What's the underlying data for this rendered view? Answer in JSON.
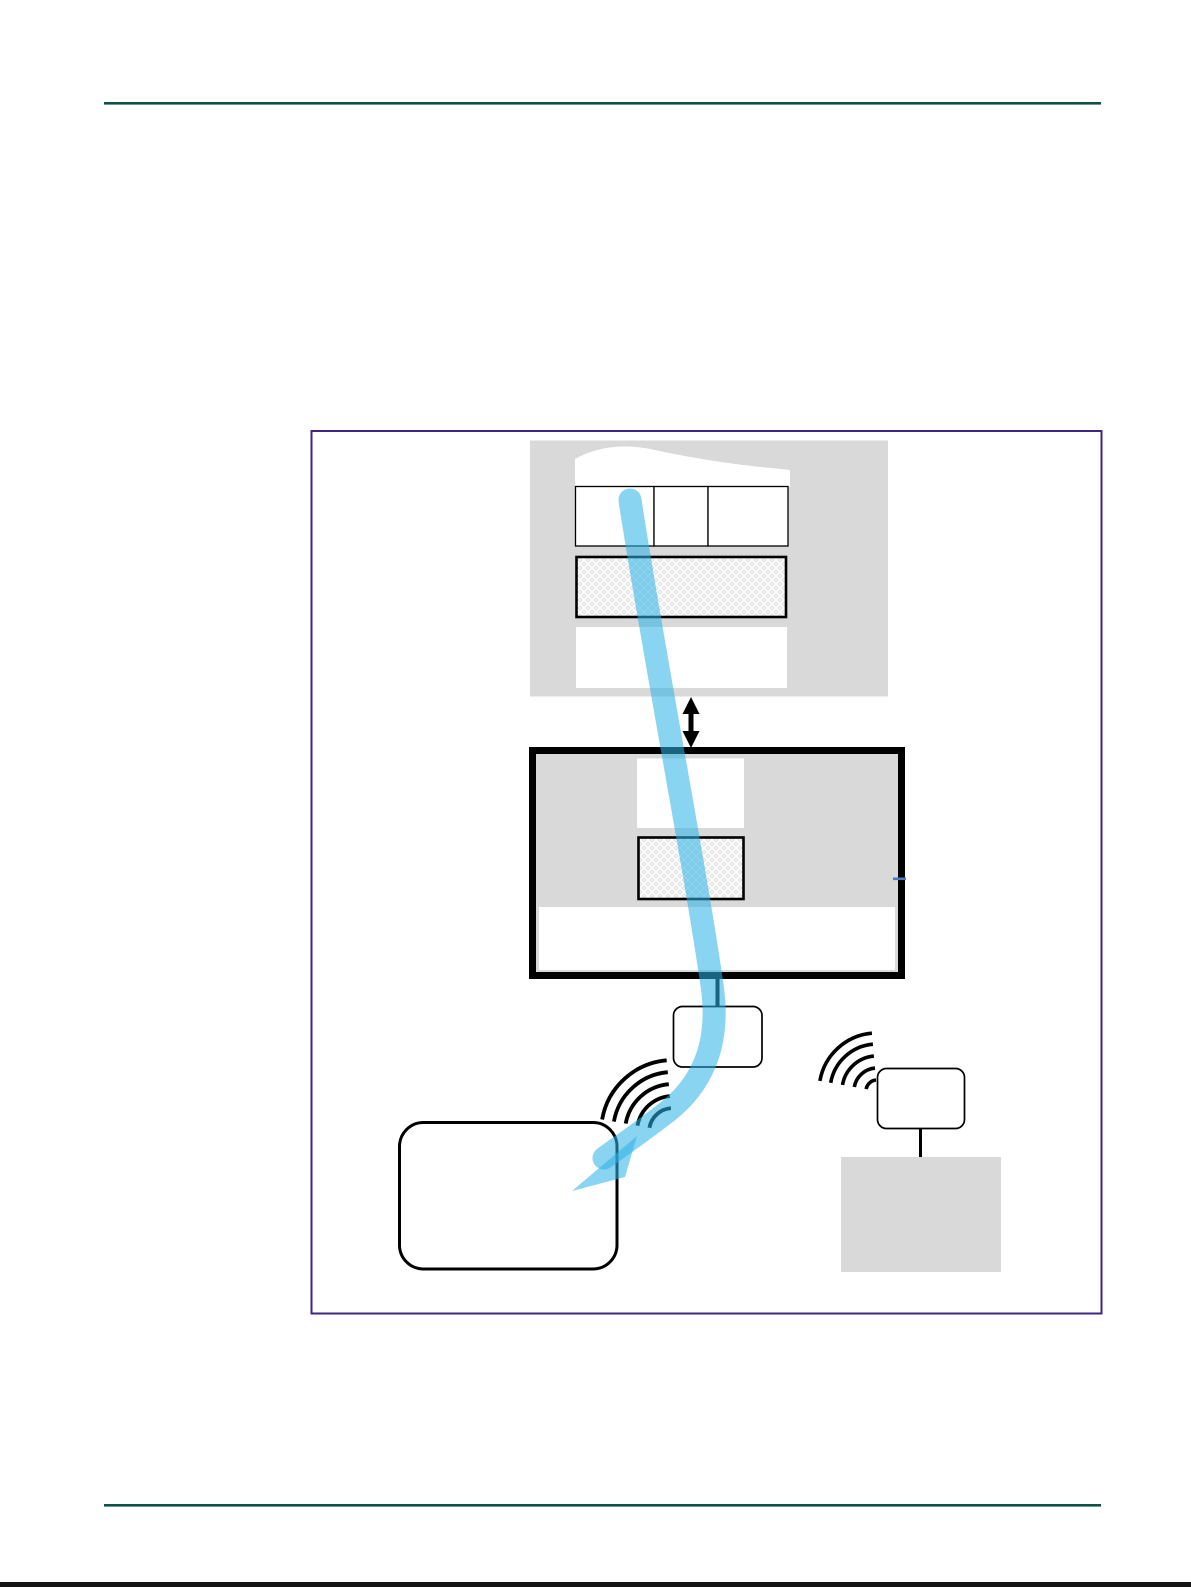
{
  "figure": {
    "alt": "Schematic figure: a light-blue signal beam travels from a ceiling-mounted panel, through a wall device with hatched filter areas, down to a wireless handheld unit; a second small wireless unit is wired to a floor-standing gray box",
    "caption": ""
  },
  "colors": {
    "page_bg": "#ffffff",
    "rule_green": "#0e5245",
    "frame_purple": "#3e2484",
    "panel_gray": "#d9d9d9",
    "hatch_bg": "#dadada",
    "hatch_line": "#ffffff",
    "line_black": "#000000",
    "beam_blue": "#2db3e6",
    "tick_blue": "#4b79c5",
    "edge_strip": "#141414",
    "white": "#ffffff"
  },
  "icons": {
    "updown_arrow": "double-headed vertical arrow",
    "wifi_waves_left": "five radiating signal arcs",
    "wifi_waves_right": "five radiating signal arcs",
    "beam_arrow": "thick translucent blue arrow"
  }
}
